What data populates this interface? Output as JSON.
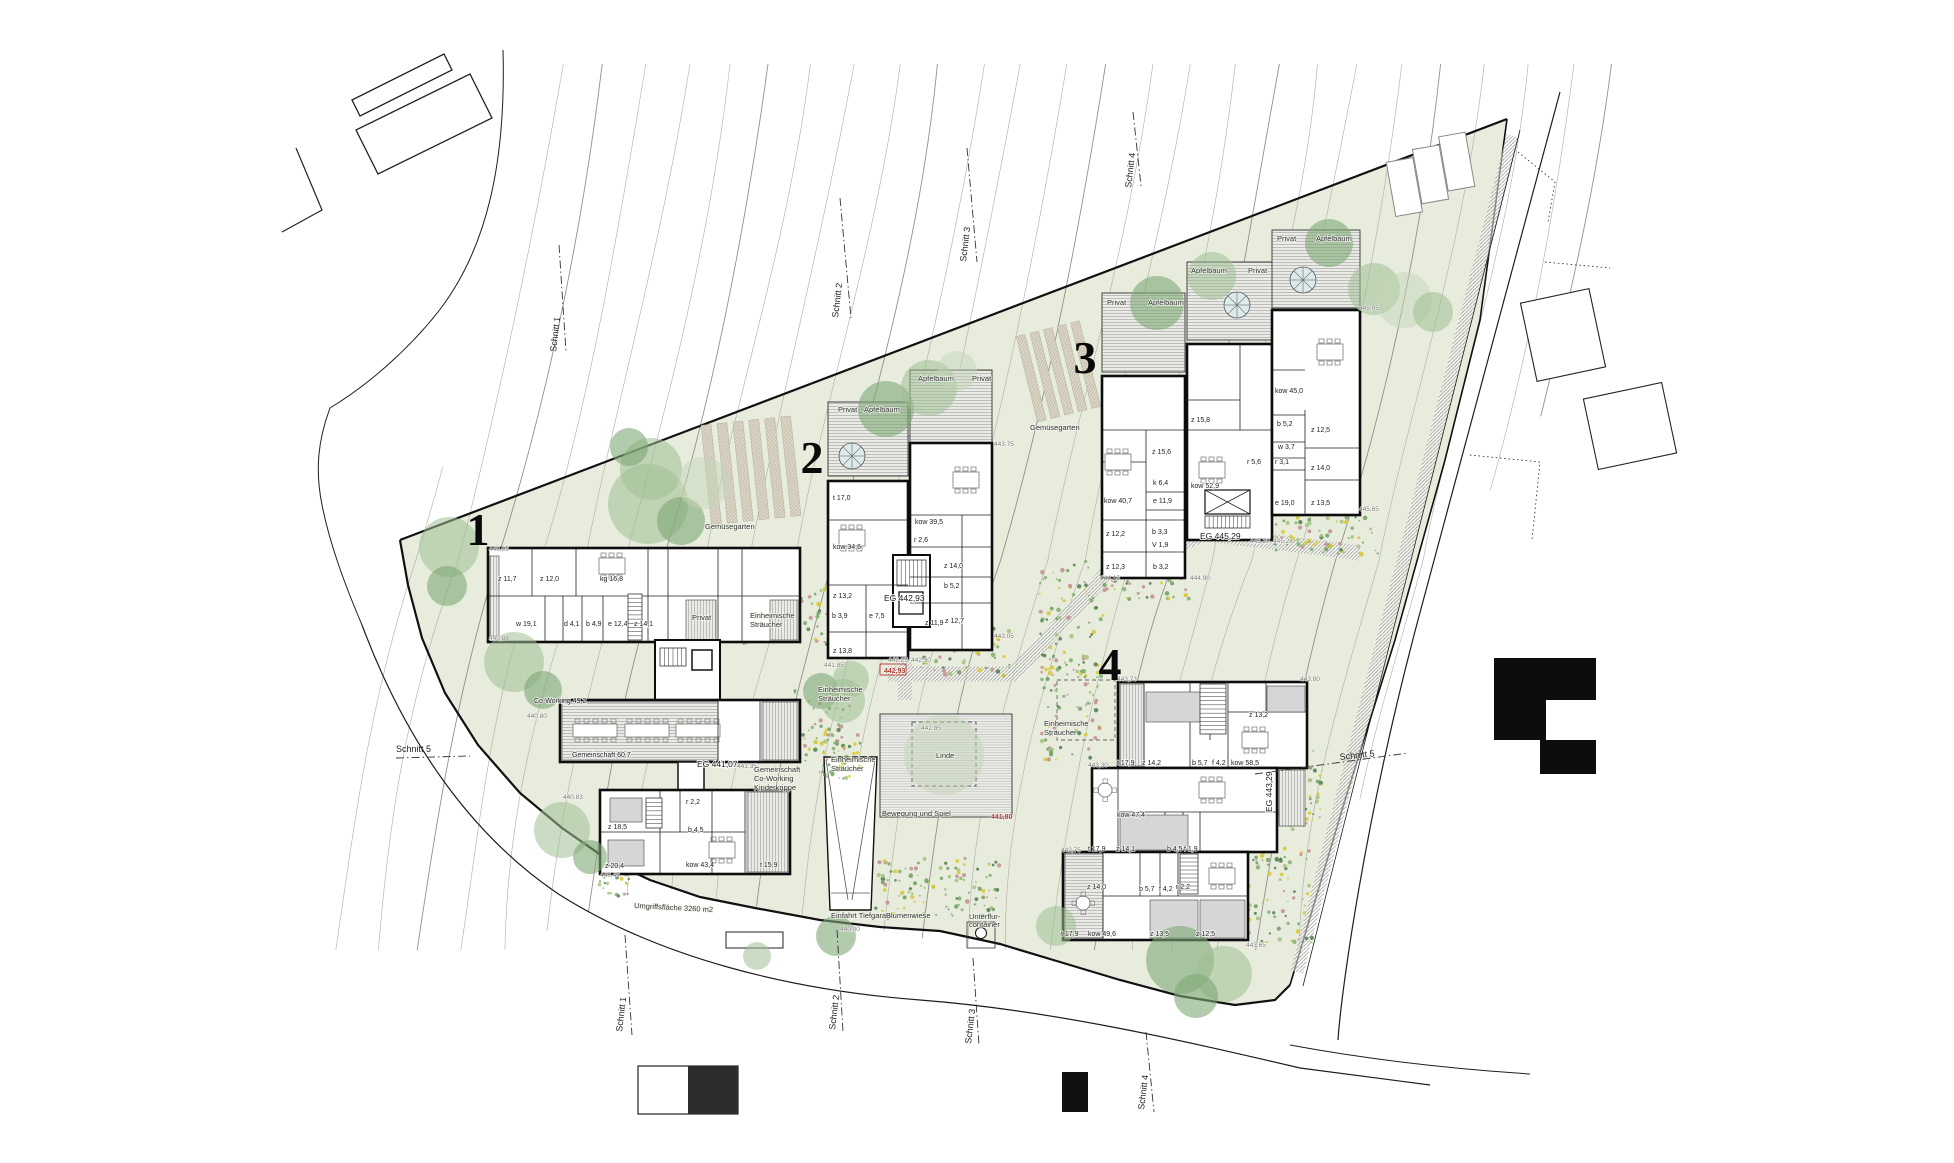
{
  "colors": {
    "site_green": "#e7ecdd",
    "tree_light": "#9fbf93",
    "tree_dark": "#7ea877",
    "tree_pale": "#c3d6b8",
    "accent_red": "#b03a2e",
    "wall_black": "#0d0d0d",
    "contour_gray": "#b2b2ac",
    "hatch_gray": "#9a9a9a",
    "soil_beige": "#ddd7c8"
  },
  "building_numbers": [
    {
      "label": "1",
      "x": 478,
      "y": 545
    },
    {
      "label": "2",
      "x": 812,
      "y": 473
    },
    {
      "label": "3",
      "x": 1085,
      "y": 373
    },
    {
      "label": "4",
      "x": 1110,
      "y": 680
    }
  ],
  "labels": [
    [
      "440,95",
      489,
      551,
      "lvl"
    ],
    [
      "z 11,7",
      498,
      581,
      "room"
    ],
    [
      "z 12,0",
      540,
      581,
      "room"
    ],
    [
      "kg 16,8",
      600,
      581,
      "room"
    ],
    [
      "w 19,1",
      516,
      626,
      "room"
    ],
    [
      "d 4,1",
      564,
      626,
      "room"
    ],
    [
      "b 4,9",
      586,
      626,
      "room"
    ],
    [
      "e 12,4",
      608,
      626,
      "room"
    ],
    [
      "z 14,1",
      634,
      626,
      "room"
    ],
    [
      "440,88",
      489,
      640,
      "lvl"
    ],
    [
      "Privat",
      692,
      620,
      "name"
    ],
    [
      "Co-Working 49,2",
      534,
      703,
      "room"
    ],
    [
      "440,80",
      527,
      718,
      "lvl"
    ],
    [
      "Gemeinschaft 60,7",
      572,
      757,
      "room"
    ],
    [
      "EG 441,07",
      697,
      767,
      "eg"
    ],
    [
      "441,35",
      737,
      768,
      "lvl"
    ],
    [
      "Gemeinschaft",
      754,
      772,
      "name"
    ],
    [
      "Co-Working",
      754,
      781,
      "name"
    ],
    [
      "Kinderkrippe",
      754,
      790,
      "name"
    ],
    [
      "z 18,5",
      608,
      829,
      "room"
    ],
    [
      "r 2,2",
      686,
      804,
      "room"
    ],
    [
      "b 4,5",
      688,
      832,
      "room"
    ],
    [
      "z 20,4",
      605,
      868,
      "room"
    ],
    [
      "kow 43,4",
      686,
      867,
      "room"
    ],
    [
      "t 15,9",
      760,
      867,
      "room"
    ],
    [
      "440,83",
      563,
      799,
      "lvl"
    ],
    [
      "440,45",
      600,
      877,
      "lvl"
    ],
    [
      "Privat",
      838,
      412,
      "name"
    ],
    [
      "Apfelbaum",
      864,
      412,
      "name"
    ],
    [
      "Apfelbaum",
      918,
      381,
      "name"
    ],
    [
      "Privat",
      972,
      381,
      "name"
    ],
    [
      "443,75",
      994,
      446,
      "lvl"
    ],
    [
      "t 17,0",
      833,
      500,
      "room"
    ],
    [
      "kow 34,6",
      833,
      549,
      "room"
    ],
    [
      "kow 39,5",
      915,
      524,
      "room"
    ],
    [
      "r 2,6",
      914,
      542,
      "room"
    ],
    [
      "z 14,0",
      944,
      568,
      "room"
    ],
    [
      "b 5,2",
      944,
      588,
      "room"
    ],
    [
      "z 13,2",
      833,
      598,
      "room"
    ],
    [
      "b 3,9",
      832,
      618,
      "room"
    ],
    [
      "e 7,5",
      869,
      618,
      "room"
    ],
    [
      "z 11,9",
      925,
      625,
      "room"
    ],
    [
      "z 12,7",
      945,
      623,
      "room"
    ],
    [
      "z 13,8",
      833,
      653,
      "room"
    ],
    [
      "EG 442,93",
      884,
      601,
      "eg"
    ],
    [
      "442,25",
      888,
      662,
      "lvl"
    ],
    [
      "442,30",
      911,
      662,
      "lvl"
    ],
    [
      "442,93",
      884,
      673,
      "red"
    ],
    [
      "441,85",
      824,
      667,
      "lvl"
    ],
    [
      "443,05",
      994,
      638,
      "lvl"
    ],
    [
      "Privat",
      1107,
      305,
      "name"
    ],
    [
      "Apfelbaum",
      1148,
      305,
      "name"
    ],
    [
      "Apfelbaum",
      1191,
      273,
      "name"
    ],
    [
      "Privat",
      1248,
      273,
      "name"
    ],
    [
      "Privat",
      1277,
      241,
      "name"
    ],
    [
      "Apfelbaum",
      1316,
      241,
      "name"
    ],
    [
      "445,05",
      1359,
      310,
      "lvl"
    ],
    [
      "kow 40,7",
      1104,
      503,
      "room"
    ],
    [
      "z 15,6",
      1152,
      454,
      "room"
    ],
    [
      "k 6,4",
      1153,
      485,
      "room"
    ],
    [
      "e 11,9",
      1153,
      503,
      "room"
    ],
    [
      "z 12,2",
      1106,
      536,
      "room"
    ],
    [
      "b 3,3",
      1152,
      534,
      "room"
    ],
    [
      "V 1,9",
      1152,
      547,
      "room"
    ],
    [
      "z 12,3",
      1106,
      569,
      "room"
    ],
    [
      "b 3,2",
      1153,
      569,
      "room"
    ],
    [
      "444,15",
      1100,
      580,
      "lvl"
    ],
    [
      "z 15,8",
      1191,
      422,
      "room"
    ],
    [
      "kow 52,9",
      1191,
      488,
      "room"
    ],
    [
      "r 5,6",
      1247,
      464,
      "room"
    ],
    [
      "EG 445,29",
      1200,
      539,
      "eg"
    ],
    [
      "445,20",
      1250,
      543,
      "lvl"
    ],
    [
      "445,28",
      1273,
      543,
      "lvl"
    ],
    [
      "444,90",
      1190,
      580,
      "lvl"
    ],
    [
      "kow 45,0",
      1275,
      393,
      "room"
    ],
    [
      "b 5,2",
      1277,
      426,
      "room"
    ],
    [
      "w 3,7",
      1278,
      449,
      "room"
    ],
    [
      "r 3,1",
      1275,
      464,
      "room"
    ],
    [
      "z 12,5",
      1311,
      432,
      "room"
    ],
    [
      "z 14,0",
      1311,
      470,
      "room"
    ],
    [
      "z 13,5",
      1311,
      505,
      "room"
    ],
    [
      "e 19,0",
      1275,
      505,
      "room"
    ],
    [
      "445,65",
      1359,
      511,
      "lvl"
    ],
    [
      "443,73",
      1117,
      681,
      "lvl"
    ],
    [
      "443,80",
      1300,
      681,
      "lvl"
    ],
    [
      "z 13,2",
      1249,
      717,
      "room"
    ],
    [
      "t 17,9",
      1117,
      765,
      "room"
    ],
    [
      "z 14,2",
      1142,
      765,
      "room"
    ],
    [
      "b 5,7",
      1192,
      765,
      "room"
    ],
    [
      "f 4,2",
      1212,
      765,
      "room"
    ],
    [
      "kow 58,5",
      1231,
      765,
      "room"
    ],
    [
      "443,30",
      1088,
      767,
      "lvl"
    ],
    [
      "kow 47,4",
      1117,
      817,
      "room"
    ],
    [
      "t 17,9",
      1088,
      851,
      "room"
    ],
    [
      "z 14,1",
      1116,
      851,
      "room"
    ],
    [
      "b 4,5",
      1167,
      851,
      "room"
    ],
    [
      "f 1,9",
      1184,
      851,
      "room"
    ],
    [
      "EG 443,29",
      1272,
      812,
      "eg",
      -90
    ],
    [
      "442,75",
      1061,
      852,
      "lvl"
    ],
    [
      "z 14,0",
      1087,
      889,
      "room"
    ],
    [
      "b 5,7",
      1139,
      891,
      "room"
    ],
    [
      "f 4,2",
      1159,
      891,
      "room"
    ],
    [
      "r 2,2",
      1176,
      889,
      "room"
    ],
    [
      "t 17,9",
      1061,
      936,
      "room"
    ],
    [
      "kow 49,6",
      1088,
      936,
      "room"
    ],
    [
      "z 13,5",
      1150,
      936,
      "room"
    ],
    [
      "z 12,5",
      1196,
      936,
      "room"
    ],
    [
      "443,65",
      1246,
      947,
      "lvl"
    ],
    [
      "Gemüsegarten",
      705,
      529,
      "name"
    ],
    [
      "Gemüsegarten",
      1030,
      430,
      "name"
    ],
    [
      "Einheimische",
      750,
      618,
      "name"
    ],
    [
      "Sträucher",
      750,
      627,
      "name"
    ],
    [
      "Einheimische",
      818,
      692,
      "name"
    ],
    [
      "Sträucher",
      818,
      701,
      "name"
    ],
    [
      "Einheimische",
      831,
      762,
      "name"
    ],
    [
      "Sträucher",
      831,
      771,
      "name"
    ],
    [
      "Einheimische",
      1044,
      726,
      "name"
    ],
    [
      "Sträucher",
      1044,
      735,
      "name"
    ],
    [
      "Linde",
      936,
      758,
      "name"
    ],
    [
      "442,85",
      921,
      730,
      "lvl"
    ],
    [
      "Bewegung und Spiel",
      882,
      816,
      "name"
    ],
    [
      "441,80",
      991,
      819,
      "red"
    ],
    [
      "Umgriffsfläche 3260 m2",
      634,
      908,
      "name",
      3
    ],
    [
      "Einfahrt Tiefgarage",
      831,
      918,
      "name"
    ],
    [
      "Blumenwiese",
      886,
      918,
      "name"
    ],
    [
      "Unterflur-",
      969,
      919,
      "name"
    ],
    [
      "container",
      969,
      927,
      "name"
    ],
    [
      "440,00",
      840,
      931,
      "lvl"
    ],
    [
      "Schnitt 1",
      556,
      352,
      "schnitt",
      -83
    ],
    [
      "Schnitt 2",
      838,
      318,
      "schnitt",
      -83
    ],
    [
      "Schnitt 3",
      966,
      262,
      "schnitt",
      -83
    ],
    [
      "Schnitt 4",
      1131,
      188,
      "schnitt",
      -83
    ],
    [
      "Schnitt 1",
      622,
      1032,
      "schnitt",
      -83
    ],
    [
      "Schnitt 2",
      835,
      1030,
      "schnitt",
      -83
    ],
    [
      "Schnitt 3",
      971,
      1044,
      "schnitt",
      -83
    ],
    [
      "Schnitt 4",
      1144,
      1110,
      "schnitt",
      -83
    ],
    [
      "Schnitt 5",
      396,
      752,
      "schnitt",
      0
    ],
    [
      "Schnitt 5",
      1340,
      760,
      "schnitt",
      -6
    ]
  ],
  "trees": [
    [
      449,
      547,
      30,
      "L"
    ],
    [
      447,
      586,
      20,
      "D"
    ],
    [
      514,
      662,
      30,
      "L"
    ],
    [
      543,
      690,
      19,
      "D"
    ],
    [
      562,
      830,
      28,
      "L"
    ],
    [
      590,
      857,
      17,
      "D"
    ],
    [
      651,
      469,
      31,
      "L"
    ],
    [
      629,
      447,
      19,
      "D"
    ],
    [
      648,
      504,
      40,
      "L"
    ],
    [
      681,
      521,
      24,
      "D"
    ],
    [
      703,
      483,
      26,
      "P"
    ],
    [
      821,
      691,
      18,
      "D"
    ],
    [
      851,
      679,
      18,
      "L"
    ],
    [
      843,
      701,
      22,
      "L"
    ],
    [
      944,
      755,
      40,
      "P"
    ],
    [
      886,
      409,
      28,
      "D"
    ],
    [
      929,
      388,
      28,
      "L"
    ],
    [
      957,
      371,
      20,
      "P"
    ],
    [
      1157,
      303,
      27,
      "D"
    ],
    [
      1212,
      276,
      24,
      "L"
    ],
    [
      1329,
      243,
      24,
      "D"
    ],
    [
      1374,
      289,
      26,
      "L"
    ],
    [
      1404,
      300,
      28,
      "P"
    ],
    [
      1433,
      312,
      20,
      "L"
    ],
    [
      1180,
      960,
      34,
      "D"
    ],
    [
      1224,
      974,
      28,
      "L"
    ],
    [
      1196,
      996,
      22,
      "D"
    ],
    [
      1056,
      926,
      20,
      "L"
    ],
    [
      836,
      936,
      20,
      "D"
    ],
    [
      757,
      956,
      14,
      "L"
    ]
  ],
  "planting_clusters": [
    [
      735,
      585,
      95,
      60,
      70
    ],
    [
      795,
      688,
      55,
      85,
      60
    ],
    [
      818,
      733,
      42,
      46,
      40
    ],
    [
      918,
      628,
      95,
      48,
      65
    ],
    [
      1038,
      560,
      65,
      120,
      80
    ],
    [
      1040,
      660,
      60,
      100,
      70
    ],
    [
      1246,
      848,
      70,
      95,
      70
    ],
    [
      1226,
      783,
      20,
      50,
      22
    ],
    [
      598,
      862,
      34,
      36,
      26
    ],
    [
      875,
      858,
      125,
      58,
      110
    ],
    [
      1275,
      505,
      105,
      52,
      70
    ],
    [
      1097,
      573,
      95,
      26,
      38
    ],
    [
      1288,
      745,
      35,
      85,
      40
    ]
  ]
}
